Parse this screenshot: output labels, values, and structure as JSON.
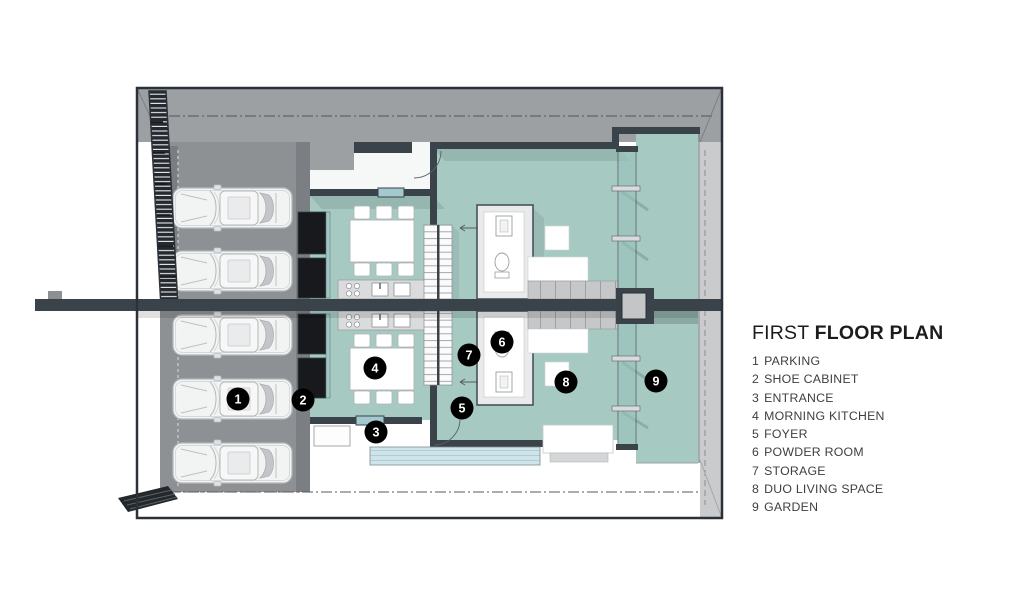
{
  "legend": {
    "title": {
      "regular": "FIRST",
      "bold": "FLOOR PLAN"
    },
    "items": [
      {
        "number": "1",
        "label": "PARKING"
      },
      {
        "number": "2",
        "label": "SHOE CABINET"
      },
      {
        "number": "3",
        "label": "ENTRANCE"
      },
      {
        "number": "4",
        "label": "MORNING KITCHEN"
      },
      {
        "number": "5",
        "label": "FOYER"
      },
      {
        "number": "6",
        "label": "POWDER ROOM"
      },
      {
        "number": "7",
        "label": "STORAGE"
      },
      {
        "number": "8",
        "label": "DUO LIVING SPACE"
      },
      {
        "number": "9",
        "label": "GARDEN"
      }
    ]
  },
  "plan": {
    "markers": [
      {
        "number": "1",
        "room": "parking",
        "x": 238,
        "y": 399
      },
      {
        "number": "2",
        "room": "shoe-cabinet",
        "x": 303,
        "y": 400
      },
      {
        "number": "3",
        "room": "entrance",
        "x": 376,
        "y": 432
      },
      {
        "number": "4",
        "room": "morning-kitchen",
        "x": 375,
        "y": 368
      },
      {
        "number": "5",
        "room": "foyer",
        "x": 462,
        "y": 408
      },
      {
        "number": "6",
        "room": "powder-room",
        "x": 502,
        "y": 342
      },
      {
        "number": "7",
        "room": "storage",
        "x": 469,
        "y": 355
      },
      {
        "number": "8",
        "room": "duo-living-space",
        "x": 566,
        "y": 382
      },
      {
        "number": "9",
        "room": "garden",
        "x": 656,
        "y": 381
      }
    ],
    "car_count": 5,
    "colors": {
      "floor_teal": "#a6cac2",
      "glass_panel": "#85b7ae",
      "glass_light": "#a3c9cf",
      "wall_dark": "#3a424a",
      "outline": "#2a3138",
      "top_band_gray": "#9da0a2",
      "right_band_gray": "#c9cbcc",
      "parking_floor": "#8e9194",
      "marker_bg": "#000000",
      "marker_text": "#ffffff",
      "legend_title": "#1c1c1c",
      "legend_text": "#3f3f3f"
    }
  }
}
